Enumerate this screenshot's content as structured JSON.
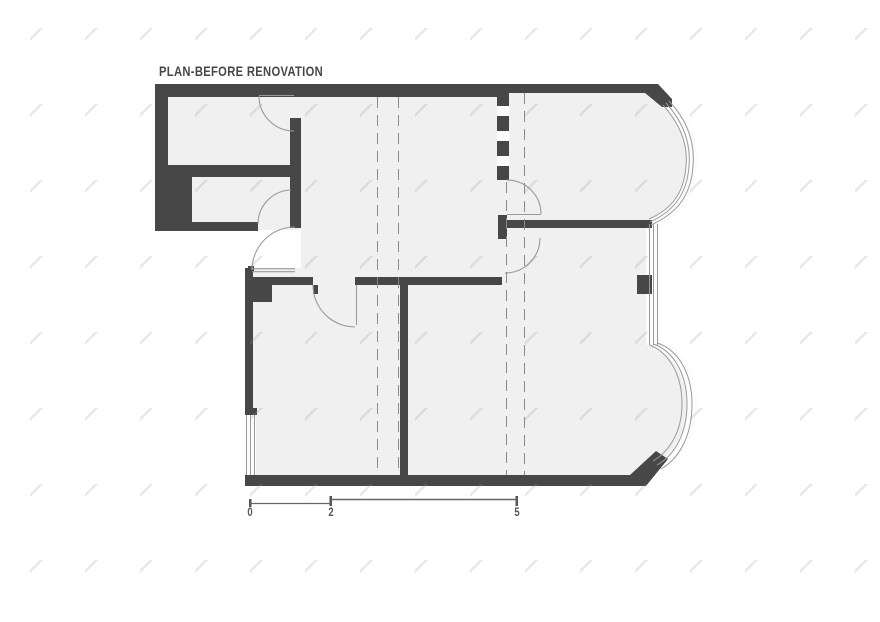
{
  "title": "PLAN-BEFORE RENOVATION",
  "drawing": {
    "kind": "architectural floor plan",
    "stage_label": "PLAN-BEFORE RENOVATION"
  },
  "scale_bar": {
    "labels": [
      "0",
      "2",
      "5"
    ]
  },
  "colors": {
    "wall": "#474747",
    "floor": "#f0f0f0",
    "thin_line": "#9a9a9a",
    "dashed_line": "#8a8a8a",
    "background": "#ffffff",
    "text": "#474747"
  }
}
